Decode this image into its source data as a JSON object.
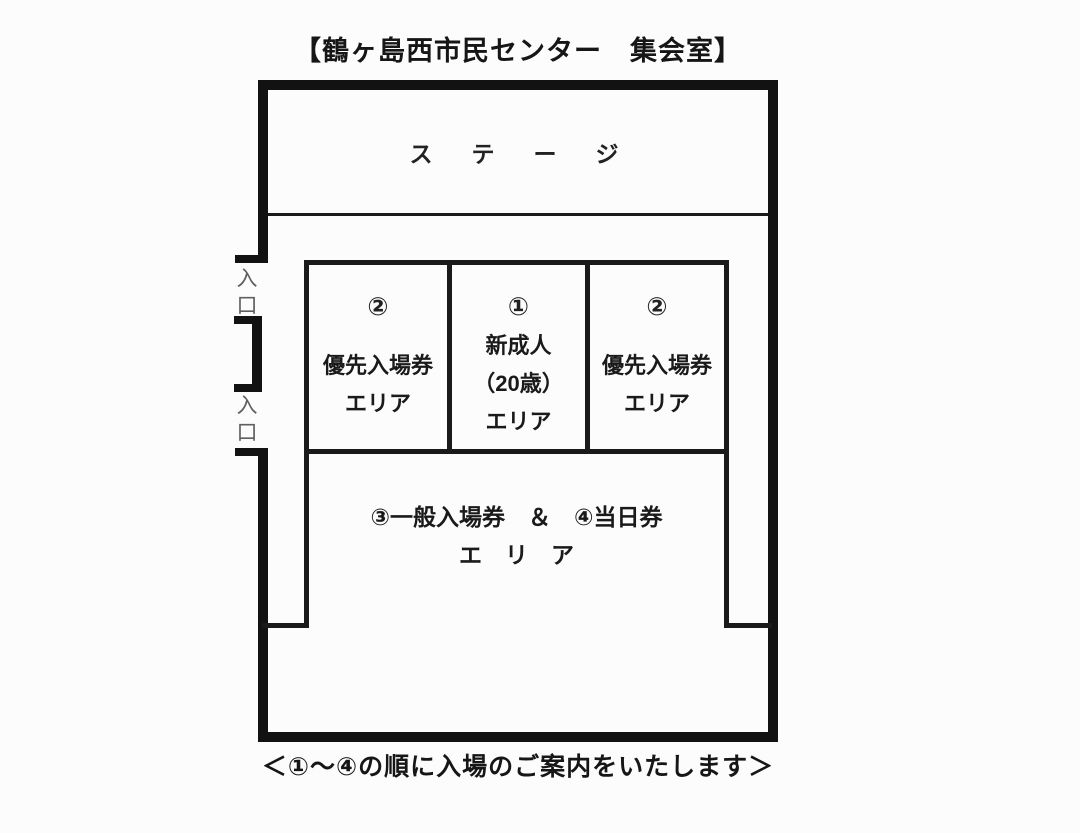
{
  "title": "【鶴ヶ島西市民センター　集会室】",
  "stage": {
    "label": "ス　テ　ー　ジ"
  },
  "entrances": [
    {
      "label": "入口"
    },
    {
      "label": "入口"
    }
  ],
  "areas": {
    "priority_left": {
      "number": "②",
      "name": "優先入場券",
      "suffix": "エリア"
    },
    "new_adult": {
      "number": "①",
      "name": "新成人",
      "detail": "（20歳）",
      "suffix": "エリア"
    },
    "priority_right": {
      "number": "②",
      "name": "優先入場券",
      "suffix": "エリア"
    },
    "general": {
      "line1": "③一般入場券　＆　④当日券",
      "line2": "エ　リ　ア"
    }
  },
  "caption": "＜①～④の順に入場のご案内をいたします＞",
  "colors": {
    "wall": "#121212",
    "line": "#1a1a1a",
    "text": "#1c1c1c",
    "entrance_text": "#5f5f5f",
    "background": "#fcfcfc"
  }
}
